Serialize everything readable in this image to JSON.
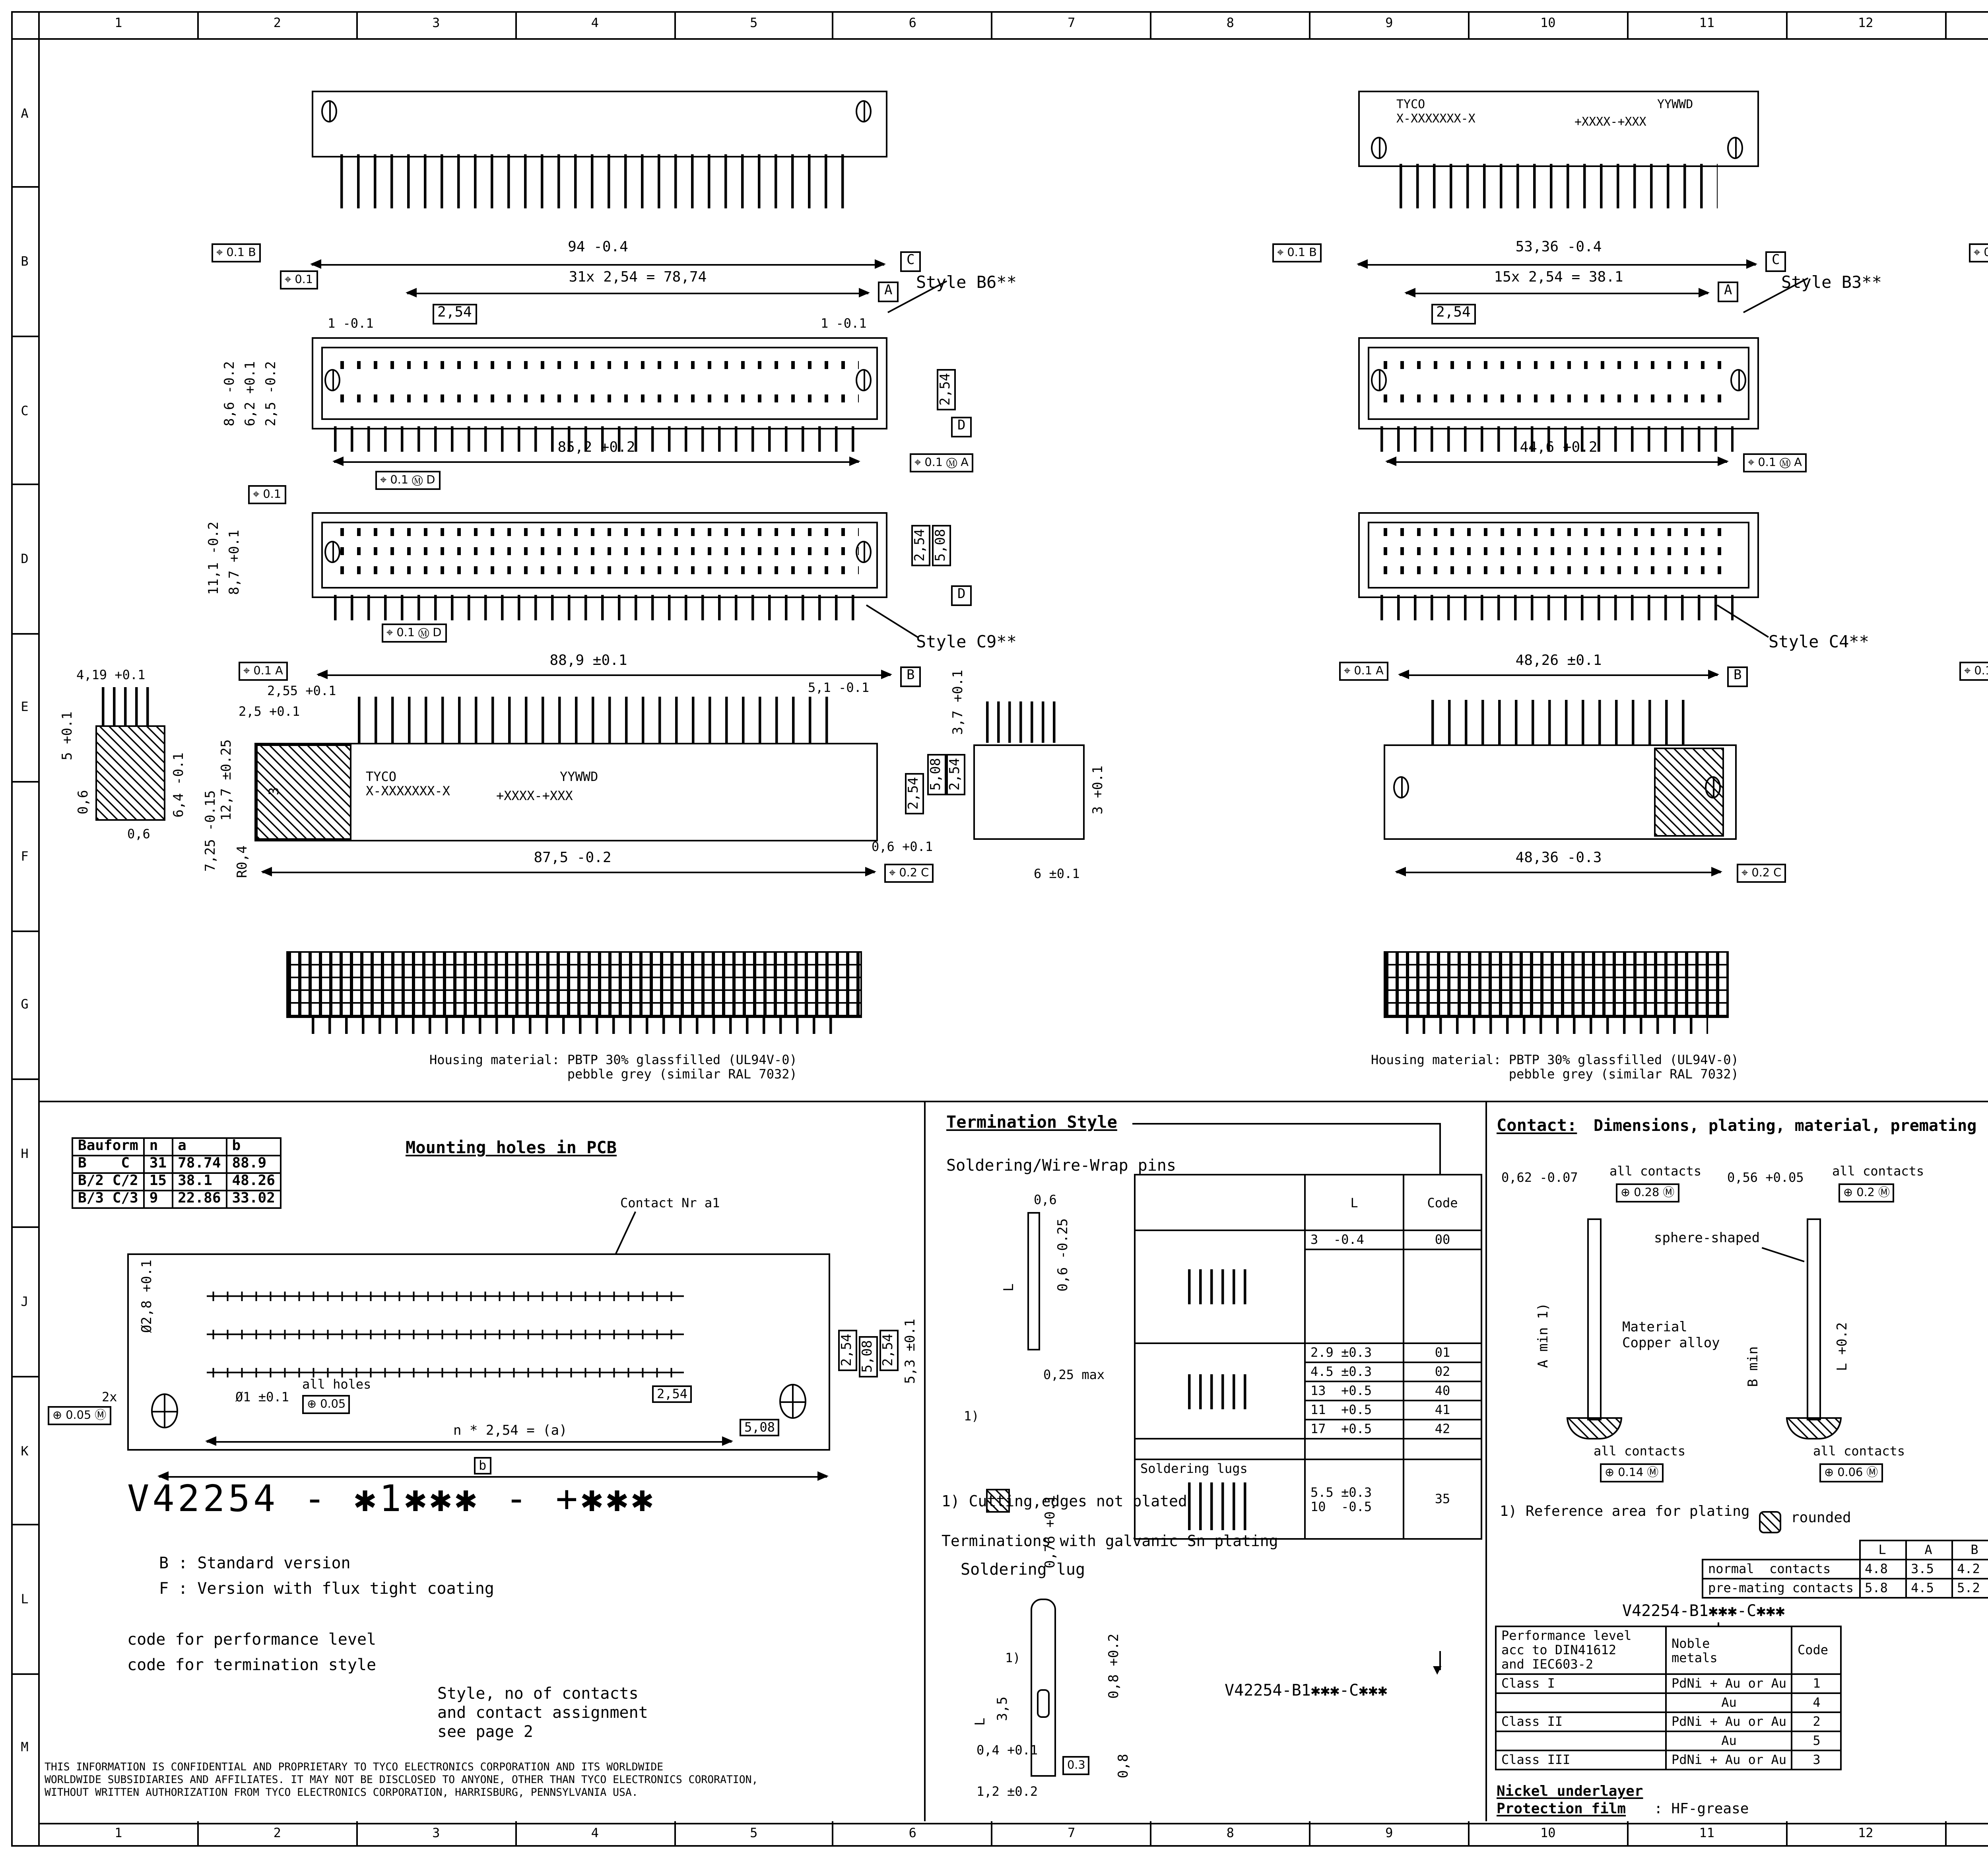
{
  "sheet": {
    "cols": [
      "1",
      "2",
      "3",
      "4",
      "5",
      "6",
      "7",
      "8",
      "9",
      "10",
      "11",
      "12",
      "13",
      "14",
      "15",
      "16"
    ],
    "rows": [
      "A",
      "B",
      "C",
      "D",
      "E",
      "F",
      "G",
      "H",
      "J",
      "K",
      "L",
      "M"
    ]
  },
  "icons": {
    "arrow_down": "▼",
    "projection": "◁ ⊕"
  },
  "v": {
    "b6": {
      "style": "Style B6**",
      "fcf_top": "⌖ 0.1 B",
      "fcf_left": "⌖ 0.1",
      "total": "94 -0.4",
      "datum_c": "C",
      "pitch_total": "31x 2,54 = 78,74",
      "datum_a": "A",
      "pitch": "2,54",
      "end_l": "1 -0.1",
      "end_r": "1 -0.1",
      "h1": "8,6 -0.2",
      "h2": "6,2 +0.1",
      "h3": "2,5 -0.2",
      "row_pitch": "2,54",
      "datum_d": "D",
      "bottom": "85,2 +0.2",
      "fcf_ba": "⌖ 0.1 Ⓜ A",
      "fcf_bd": "⌖ 0.1 Ⓜ D"
    },
    "b3": {
      "style": "Style B3**",
      "tyco": "TYCO\nX-XXXXXXX-X",
      "date": "YYWWD",
      "code": "+XXXX-+XXX",
      "fcf_top": "⌖ 0.1 B",
      "total": "53,36 -0.4",
      "datum_c": "C",
      "pitch_total": "15x 2,54 = 38.1",
      "datum_a": "A",
      "pitch": "2,54",
      "bottom": "44,6 +0.2",
      "fcf_ba": "⌖ 0.1 Ⓜ A"
    },
    "b2": {
      "style": "Style B2**",
      "tyco": "TYCO\nX-XXXXXXX-X",
      "date": "YYWWD",
      "fcf_top": "⌖ 0.1 B",
      "total": "38,12 -0.4",
      "datum_c": "C",
      "pitch_total": "9x 2,54 = 22.86",
      "datum_a": "A",
      "pitch": "2,54",
      "bottom": "29,42 +0.2",
      "fcf_ba": "⌖ 0.1 Ⓜ A"
    },
    "c9": {
      "style": "Style C9**",
      "fcf_top": "⌖ 0.1",
      "h1": "11,1 -0.2",
      "h2": "8,7 +0.1",
      "r1": "2,54",
      "r2": "5,08",
      "datum_d": "D",
      "fcf_bd": "⌖ 0.1 Ⓜ D"
    },
    "c4": {
      "style": "Style C4**"
    },
    "c3": {
      "style": "Style C3**"
    },
    "ef1": {
      "fcf_a": "⌖ 0.1 A",
      "top": "88,9 ±0.1",
      "datum_b": "B",
      "s1": "4,19 +0.1",
      "s2": "5 +0.1",
      "s3": "0,6",
      "s4": "0,6",
      "s5": "6,4 -0.1",
      "m1": "2,55 +0.1",
      "m2": "2,5 +0.1",
      "m3": "3",
      "m4": "12,7 ±0.25",
      "m5": "7,25 -0.15",
      "m6": "R0,4",
      "tyco": "TYCO\nX-XXXXXXX-X",
      "code": "+XXXX-+XXX",
      "date": "YYWWD",
      "bottom": "87,5 -0.2",
      "fcf_c": "⌖ 0.2 C",
      "r1": "5,1 -0.1",
      "r2": "3,7 +0.1",
      "r3": "5,08",
      "r4": "2,54",
      "r5": "2,54",
      "r6": "3 +0.1",
      "r7": "0,6 +0.1",
      "r8": "6 ±0.1"
    },
    "ef2": {
      "fcf_a": "⌖ 0.1 A",
      "top": "48,26 ±0.1",
      "datum_b": "B",
      "bottom": "48,36 -0.3",
      "fcf_c": "⌖ 0.2 C"
    },
    "ef3": {
      "fcf_a": "⌖ 0.1 A",
      "top": "33,02 ±0.1",
      "datum_b": "B",
      "bottom": "33,12 -0.3",
      "fcf_c": "⌖ 0.2 C"
    },
    "housing": "Housing material: PBTP 30% glassfilled (UL94V-0)\n                  pebble grey (similar RAL 7032)"
  },
  "pcb": {
    "table": {
      "h": [
        "Bauform",
        "n",
        "a",
        "b"
      ],
      "r": [
        [
          "B    C",
          "31",
          "78.74",
          "88.9"
        ],
        [
          "B/2 C/2",
          "15",
          "38.1",
          "48.26"
        ],
        [
          "B/3 C/3",
          "9",
          "22.86",
          "33.02"
        ]
      ]
    },
    "title": "Mounting holes in PCB",
    "contact_nr": "Contact Nr a1",
    "dia1": "Ø2,8 +0.1",
    "two_x": "2x",
    "fcf1": "⊕ 0.05 Ⓜ",
    "dia2": "Ø1 ±0.1",
    "all_holes": "all holes",
    "fcf2": "⊕ 0.05",
    "pitch": "2,54",
    "n_pitch": "n * 2,54 = (a)",
    "d508": "5,08",
    "b": "b",
    "r1": "2,54",
    "r2": "5,08",
    "r3": "2,54",
    "r4": "5,3 ±0.1",
    "pn": "V42254 - ✱1✱✱✱ - +✱✱✱",
    "leg1": "B : Standard version",
    "leg2": "F : Version with flux tight coating",
    "leg3": "code for performance level",
    "leg4": "code for termination style",
    "leg5": "Style, no of contacts\nand contact assignment\nsee page 2",
    "disclaimer": "THIS INFORMATION IS CONFIDENTIAL AND PROPRIETARY TO TYCO ELECTRONICS CORPORATION AND ITS WORLDWIDE\nWORLDWIDE SUBSIDIARIES AND AFFILIATES. IT MAY NOT BE DISCLOSED TO ANYONE, OTHER THAN TYCO ELECTRONICS CORORATION,\nWITHOUT WRITTEN AUTHORIZATION FROM TYCO ELECTRONICS CORPORATION, HARRISBURG, PENNSYLVANIA USA."
  },
  "term": {
    "title": "Termination Style",
    "sub": "Soldering/Wire-Wrap pins",
    "d1": "0,6",
    "d2": "L",
    "d3": "0,6 -0.25",
    "d4": "0,25 max",
    "note_ref": "1)",
    "d5": "0,76 +0.1",
    "col_l": "L",
    "col_code": "Code",
    "rows": [
      [
        "3  -0.4",
        "00"
      ],
      [
        "2.9 ±0.3",
        "01"
      ],
      [
        "4.5 ±0.3",
        "02"
      ],
      [
        "13  +0.5",
        "40"
      ],
      [
        "11  +0.5",
        "41"
      ],
      [
        "17  +0.5",
        "42"
      ]
    ],
    "lug_label": "Soldering lugs",
    "lug_l": "5.5 ±0.3\n10  -0.5",
    "lug_code": "35",
    "note1": "1) Cutting,edges not plated",
    "note2": "Terminations with galvanic Sn plating",
    "pn": "V42254-B1✱✱✱-C✱✱✱",
    "sub2": "Soldering lug",
    "l1": "L",
    "l2": "3,5",
    "l3": "1)",
    "l4": "0,8 +0.2",
    "l5": "0,8",
    "l6": "0,4 +0.1",
    "l7": "0.3",
    "l8": "1,2 ±0.2"
  },
  "contact": {
    "title1": "Contact:",
    "title2": "Dimensions, plating, material, premating",
    "d1": "0,62 -0.07",
    "ac": "all contacts",
    "fcf1": "⊕ 0.28 Ⓜ",
    "d2": "0,56 +0.05",
    "fcf2": "⊕ 0.2 Ⓜ",
    "sphere": "sphere-shaped",
    "amin": "A min 1)",
    "mat": "Material\nCopper alloy",
    "bmin": "B min",
    "l02": "L +0.2",
    "fcf3": "⊕ 0.14 Ⓜ",
    "fcf4": "⊕ 0.06 Ⓜ",
    "note1": "1) Reference area for plating",
    "rounded": "rounded",
    "lab": {
      "h0": "",
      "h": [
        "L",
        "A",
        "B"
      ],
      "r1l": "normal  contacts",
      "r1": [
        "4.8",
        "3.5",
        "4.2"
      ],
      "r2l": "pre-mating contacts",
      "r2": [
        "5.8",
        "4.5",
        "5.2"
      ]
    },
    "pn": "V42254-B1✱✱✱-C✱✱✱",
    "perf": {
      "h1": "Performance level\nacc to DIN41612\nand IEC603-2",
      "h2": "Noble\nmetals",
      "h3": "Code",
      "rows": [
        [
          "Class I",
          "PdNi + Au or Au",
          "1"
        ],
        [
          "",
          "Au",
          "4"
        ],
        [
          "Class II",
          "PdNi + Au or Au",
          "2"
        ],
        [
          "",
          "Au",
          "5"
        ],
        [
          "Class III",
          "PdNi + Au or Au",
          "3"
        ]
      ]
    },
    "nickel": "Nickel underlayer",
    "film": "Protection film",
    "film2": ": HF-grease"
  },
  "male": {
    "title": "Male connecctor with board locks",
    "rows_abc": [
      "c",
      "b",
      "a"
    ],
    "d1": "1.3 max",
    "d2": "1,85 +0.25",
    "d3": "3.35 +0.2",
    "d4": "3 max",
    "note1": "Mounted in PC-boards\nof 1.5 to 1.8 mm\nFm =< 60 N\nFr >= 20 N\nFr >= 200 N, wenn\n  soldered-in",
    "fm": "Fm = Mounting force\n(for 1 connector = 2 Clips)",
    "fr": "Fr = Retention force\n(for 1 connector = 2 Clips)",
    "note2": "Mounted in PC-boards\nover 1.8 mm\nFm =< 60 N\nFr >= 16 N"
  },
  "tb": {
    "logo": "TE",
    "brand": "TE Connectivity",
    "loc": "Loc",
    "gw": "GW",
    "dim1": "DIMENSIONS",
    "dim2": "IN MM",
    "scale": "SCALE",
    "weight": "WEIGHT",
    "material": "MATERIAL",
    "date_l": "DATE",
    "date": "10.02.89",
    "name_l": "NAME",
    "name": "Cuvelier",
    "dep_l": "DEP.",
    "dep": "PD COM",
    "tol": "TOLERANCE UNLESS\nSPECIFIED OTHERWISE",
    "pn_l": "PART NAME",
    "pn1": "Pin Assembly Eurocard",
    "pn2": "Types B, C and short versions",
    "no_l": "PART NO.",
    "no": "V42254-B1✱✱✱-C✱✱✱-✱-7626",
    "sht_l": "SHT.",
    "sht": "1+",
    "of_l": "OF",
    "of": "2",
    "rev": "REV.",
    "co": "CHANGE ORDER",
    "date2": "DATE",
    "app": "APP.",
    "customer": "Customer Drawing Nr. C  1392009-8"
  }
}
